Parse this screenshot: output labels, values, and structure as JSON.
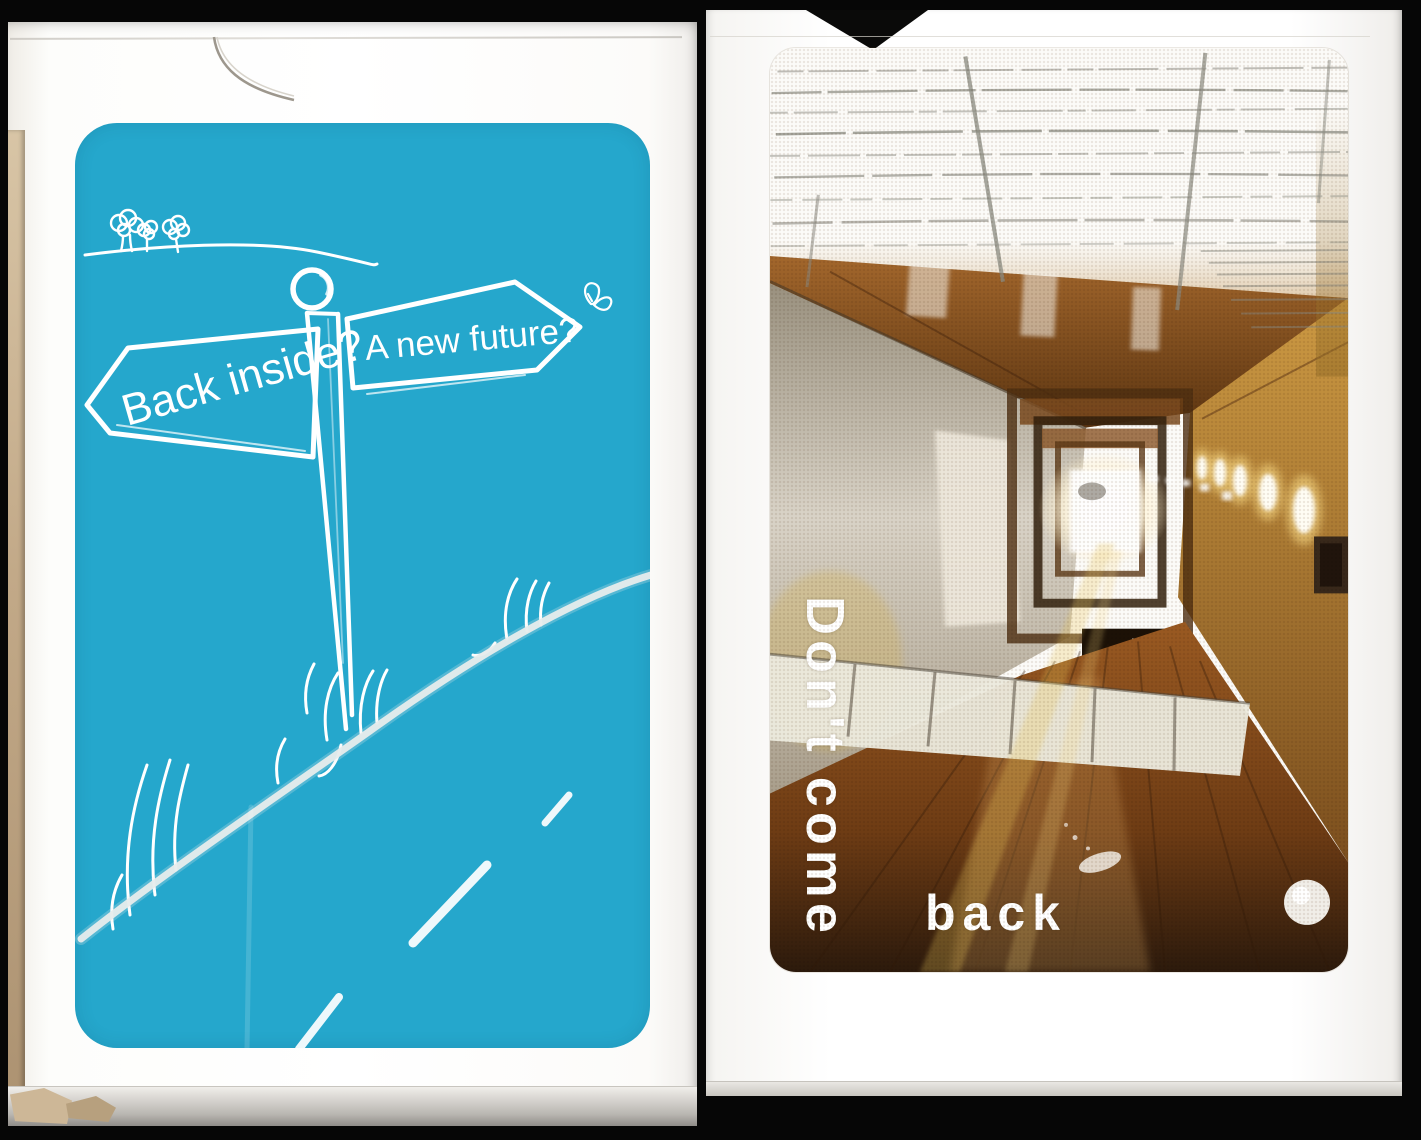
{
  "scene": {
    "background_color": "#060606"
  },
  "left_box": {
    "base_color": "#FFFFFF",
    "side_edge_color": "#C2A988",
    "card_back": {
      "background_color": "#25A7CC",
      "ink_color": "#FFFFFF",
      "left_sign_label": "Back inside?",
      "right_sign_label": "A new future?",
      "doodles": [
        "horizon-line",
        "trees-icon",
        "butterfly-icon",
        "signpost",
        "grass-tufts",
        "road-line",
        "road-dashes"
      ]
    }
  },
  "right_box": {
    "base_color": "#FFFFFF",
    "photo": {
      "caption_vertical": "Don't come",
      "caption_horizontal": "back",
      "caption_color": "#FFFFFF",
      "elements": [
        "barbed-wire-fence",
        "corridor",
        "vanishing-light",
        "wall-lights",
        "radiator-panels",
        "wood-floor"
      ]
    }
  }
}
